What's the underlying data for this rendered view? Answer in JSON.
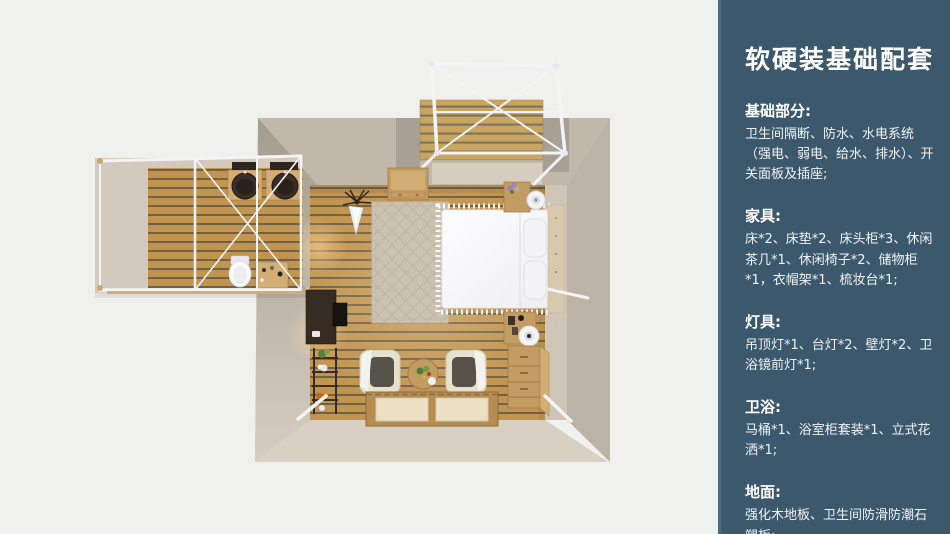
{
  "sidebar": {
    "title": "软硬装基础配套",
    "sections": [
      {
        "heading": "基础部分:",
        "body": "卫生间隔断、防水、水电系统（强电、弱电、给水、排水）、开关面板及插座;"
      },
      {
        "heading": "家具:",
        "body": "床*2、床垫*2、床头柜*3、休闲茶几*1、休闲椅子*2、储物柜*1，衣帽架*1、梳妆台*1;"
      },
      {
        "heading": "灯具:",
        "body": "吊顶灯*1、台灯*2、壁灯*2、卫浴镜前灯*1;"
      },
      {
        "heading": "卫浴:",
        "body": "马桶*1、浴室柜套装*1、立式花洒*1;"
      },
      {
        "heading": "地面:",
        "body": "强化木地板、卫生间防滑防潮石塑板;"
      }
    ]
  },
  "floorplan": {
    "type": "top-view-3d-room-render",
    "items": [
      "deck-canopy-frame",
      "wood-deck",
      "bathroom-wing",
      "bathroom-frame",
      "twin-wash-basins",
      "toilet",
      "vanity-cabinet",
      "double-bed",
      "pillows",
      "headboard",
      "area-rug",
      "storage-cabinet",
      "coat-rack",
      "nightstand-top",
      "table-lamp-top",
      "nightstand-bottom",
      "table-lamp-bottom",
      "chest-of-drawers",
      "dressing-desk",
      "tv-panel",
      "plant-shelf",
      "armchair-left",
      "armchair-right",
      "round-tea-table",
      "tatami-platform"
    ]
  },
  "palette": {
    "pageBg": "#f0f0ee",
    "sidebarBg": "#3b586c",
    "sidebarEdge": "#4c687b",
    "sidebarText": "#ffffff",
    "sidebarBody": "#f0f4f6",
    "wallTop": "#c2b8aa",
    "wallGray": "#a8a094",
    "wallInnerRight": "#cfc5b7",
    "wallOuterRight": "#bcb2a5",
    "wallBottom": "#d9d0c4",
    "wingWall": "#d3cabd",
    "floorWood": "#c2954f",
    "floorGap": "#75603f",
    "deckWood": "#c9a55f",
    "deckGap": "#777063",
    "frameWhite": "#f4f4f6",
    "bedWhite": "#fbfbfd",
    "pillow": "#f4f4f7",
    "headboard": "#d8c9ae",
    "rugBase": "#ccc2b2",
    "rugLine": "#bdb2a0",
    "woodMid": "#c39c63",
    "woodLight": "#d2ad74",
    "woodDark": "#a17c49",
    "darkFurniture": "#362c23",
    "tvBlack": "#17130f",
    "cream": "#e6e1cd",
    "seatDark": "#57534a",
    "matCream": "#ecdfc4",
    "basinDark": "#3a2e28",
    "toiletWhite": "#fafafa",
    "green": "#5e7d3c",
    "purple": "#9b86b5",
    "orange": "#c06a28"
  }
}
